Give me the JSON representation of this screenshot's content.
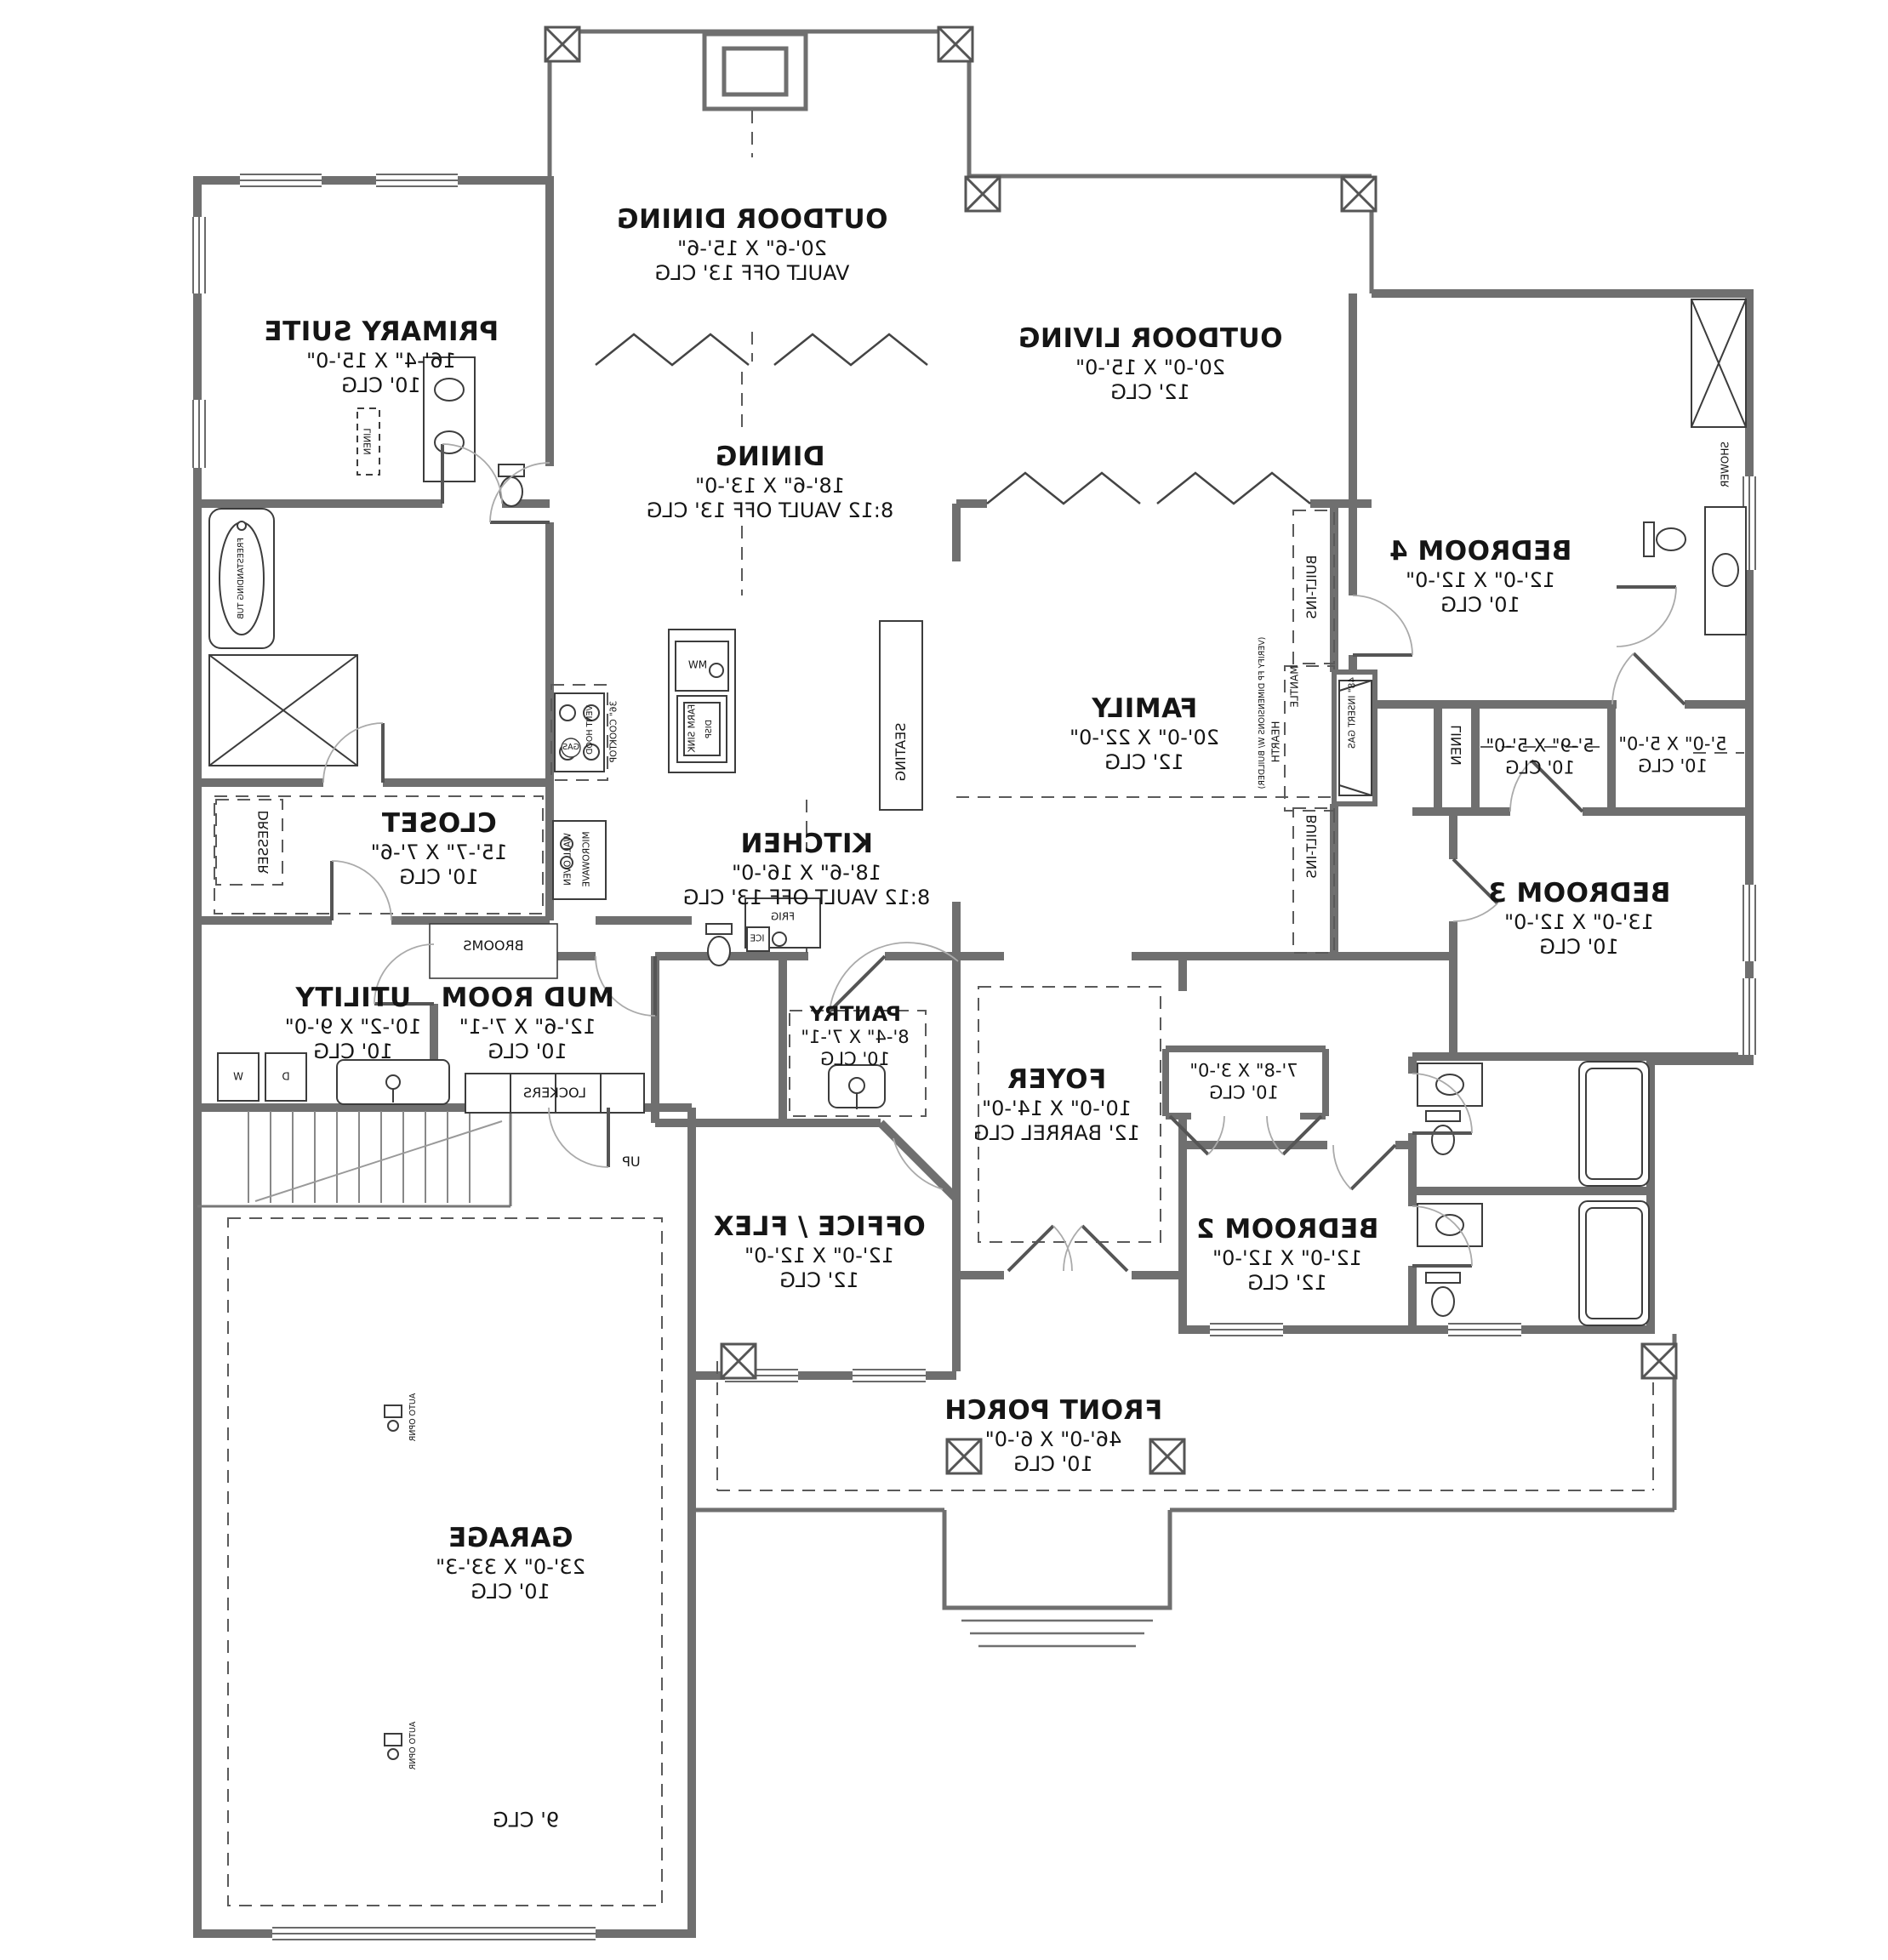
{
  "plan": {
    "rooms": [
      {
        "name": "PRIMARY SUITE",
        "dims": "16'-4\" X 15'-0\"",
        "clg": "10' CLG"
      },
      {
        "name": "OUTDOOR DINING",
        "dims": "20'-6\" X 15'-6\"",
        "clg": "VAULT OFF 13' CLG"
      },
      {
        "name": "OUTDOOR LIVING",
        "dims": "20'-0\" X 15'-0\"",
        "clg": "12' CLG"
      },
      {
        "name": "DINING",
        "dims": "18'-6\" X 13'-0\"",
        "clg": "8:12 VAULT OFF 13' CLG"
      },
      {
        "name": "BEDROOM 4",
        "dims": "12'-0\" X 12'-0\"",
        "clg": "10' CLG"
      },
      {
        "name": "FAMILY",
        "dims": "20'-0\" X 22'-0\"",
        "clg": "12' CLG"
      },
      {
        "name": "KITCHEN",
        "dims": "18'-6\" X 16'-0\"",
        "clg": "8:12 VAULT OFF 13' CLG"
      },
      {
        "name": "CLOSET",
        "dims": "15'-7\" X 7'-6\"",
        "clg": "10' CLG"
      },
      {
        "name": "BEDROOM 3",
        "dims": "13'-0\" X 12'-0\"",
        "clg": "10' CLG"
      },
      {
        "name": "UTILITY",
        "dims": "10'-2\" X 9'-0\"",
        "clg": "10' CLG"
      },
      {
        "name": "MUD ROOM",
        "dims": "12'-6\" X 7'-1\"",
        "clg": "10' CLG"
      },
      {
        "name": "PANTRY",
        "dims": "8'-4\" X 7'-1\"",
        "clg": "10' CLG"
      },
      {
        "name": "FOYER",
        "dims": "10'-0\" X 14'-0\"",
        "clg": "12' BARREL CLG"
      },
      {
        "name": "OFFICE / FLEX",
        "dims": "12'-0\" X 12'-0\"",
        "clg": "12' CLG"
      },
      {
        "name": "BEDROOM 2",
        "dims": "12'-0\" X 12'-0\"",
        "clg": "12' CLG"
      },
      {
        "name": "FRONT PORCH",
        "dims": "46'-0\" X 6'-0\"",
        "clg": "10' CLG"
      },
      {
        "name": "GARAGE",
        "dims": "23'-0\" X 33'-3\"",
        "clg": "10' CLG"
      }
    ],
    "closets": [
      {
        "dims": "7'-8\" X 3'-0\"",
        "clg": "10' CLG"
      },
      {
        "dims": "5'-9\" X 5'-0\"",
        "clg": "10' CLG"
      },
      {
        "dims": "5'-0\" X 5'-0\"",
        "clg": "10' CLG"
      }
    ],
    "labels": {
      "dresser": "DRESSER",
      "linen": "LINEN",
      "brooms": "BROOMS",
      "lockers": "LOCKERS",
      "up": "UP",
      "washer": "W",
      "dryer": "D",
      "seating": "SEATING",
      "cooktop": "36\" COOKTOP",
      "vent_hood": "VENT HOOD",
      "gas": "GAS",
      "wall_oven": "WALL OVEN",
      "microwave": "MICROWAVE",
      "farm_sink": "FARM SINK",
      "disp": "DISP",
      "mw": "MW",
      "frig": "FRIG",
      "ice": "ICE",
      "mantle": "MANTLE",
      "hearth": "HEARTH",
      "fp_insert": "48\" INSERT GAS",
      "fp_verify": "(VERIFY FP DIMENSIONS W/ BUILDER)",
      "built_ins": "BUILT-INS",
      "auto_opnr": "AUTO OPNR",
      "shower": "SHOWER",
      "tub": "FREESTANDING TUB",
      "garage_rear_clg": "9' CLG"
    }
  }
}
